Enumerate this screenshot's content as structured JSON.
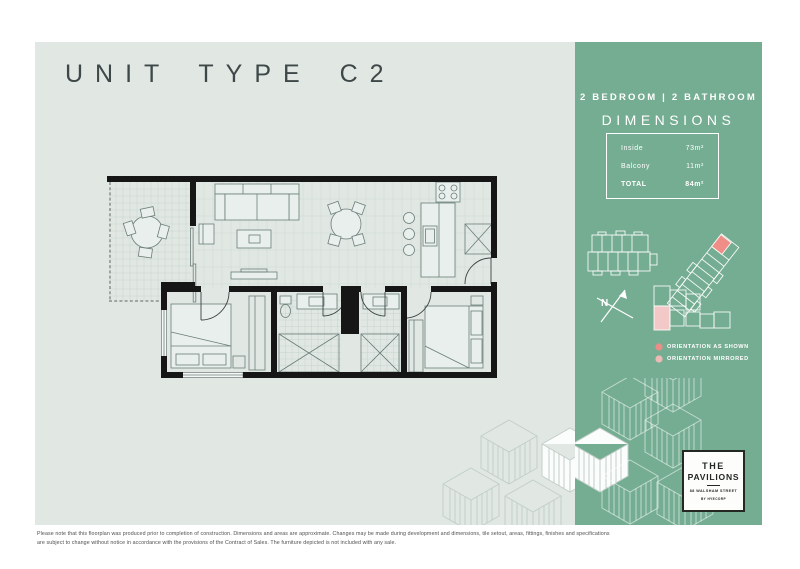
{
  "page": {
    "title": "UNIT TYPE C2"
  },
  "sidebar": {
    "subtitle": "2 BEDROOM | 2 BATHROOM",
    "dimensions_heading": "DIMENSIONS",
    "dimensions": [
      {
        "label": "Inside",
        "value": "73m²"
      },
      {
        "label": "Balcony",
        "value": "11m²"
      },
      {
        "label": "TOTAL",
        "value": "84m²"
      }
    ],
    "compass_label": "N",
    "legend": [
      {
        "label": "ORIENTATION AS SHOWN",
        "color": "#ec8e87"
      },
      {
        "label": "ORIENTATION MIRRORED",
        "color": "#eebab5"
      }
    ],
    "logo": {
      "name_line1": "THE",
      "name_line2": "PAVILIONS",
      "address": "88 WALSHAM STREET",
      "byline": "BY HYECORP"
    }
  },
  "colors": {
    "panel": "#e1e8e4",
    "sidebar_green": "#75ad92",
    "highlight_pink": "#ee8e87",
    "highlight_pink_light": "#f2c9c7"
  },
  "footer": {
    "disclaimer_line1": "Please note that this floorplan was produced prior to completion of construction. Dimensions and areas are approximate. Changes may be made during development and dimensions, tile setout, areas, fittings, finishes and specifications",
    "disclaimer_line2": "are subject to change without notice in accordance with the provisions of the Contract of Sales. The furniture depicted is not included with any sale."
  }
}
